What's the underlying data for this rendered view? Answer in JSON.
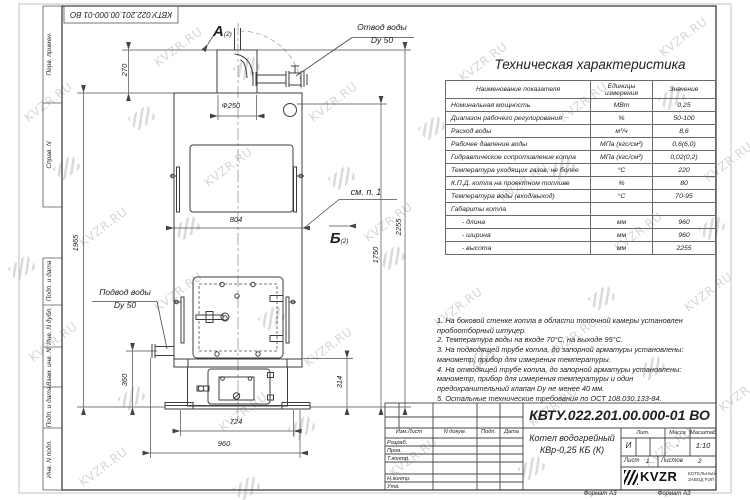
{
  "watermark": {
    "text": "KVZR.RU",
    "text_positions": [
      [
        20,
        95
      ],
      [
        75,
        220
      ],
      [
        25,
        335
      ],
      [
        75,
        460
      ],
      [
        150,
        40
      ],
      [
        200,
        160
      ],
      [
        150,
        285
      ],
      [
        215,
        405
      ],
      [
        305,
        95
      ],
      [
        360,
        215
      ],
      [
        300,
        340
      ],
      [
        385,
        450
      ],
      [
        455,
        55
      ],
      [
        495,
        175
      ],
      [
        430,
        300
      ],
      [
        525,
        400
      ],
      [
        555,
        95
      ],
      [
        610,
        225
      ],
      [
        545,
        330
      ],
      [
        640,
        440
      ],
      [
        655,
        30
      ],
      [
        700,
        155
      ],
      [
        680,
        285
      ],
      [
        715,
        385
      ]
    ],
    "logo_positions": [
      [
        55,
        160
      ],
      [
        10,
        260
      ],
      [
        130,
        110
      ],
      [
        235,
        60
      ],
      [
        175,
        220
      ],
      [
        120,
        390
      ],
      [
        260,
        310
      ],
      [
        330,
        170
      ],
      [
        290,
        420
      ],
      [
        420,
        120
      ],
      [
        380,
        250
      ],
      [
        470,
        350
      ],
      [
        550,
        160
      ],
      [
        590,
        290
      ],
      [
        520,
        460
      ],
      [
        660,
        90
      ],
      [
        700,
        220
      ],
      [
        640,
        360
      ],
      [
        235,
        480
      ]
    ]
  },
  "corner_stamp": {
    "doc_number": "КВТУ.022.201.00.000-01 ВО"
  },
  "side_strip": {
    "items": [
      {
        "label": "Перв. примен."
      },
      {
        "label": "Справ. N"
      },
      {
        "label": "Подп. и дата"
      },
      {
        "label": "Инв. N дубл."
      },
      {
        "label": "Взам. инв. N"
      },
      {
        "label": "Подп. и дата"
      },
      {
        "label": "Инв. N подл."
      }
    ]
  },
  "drawing": {
    "view_a": {
      "letter": "А",
      "ref": "(2)"
    },
    "view_b": {
      "letter": "Б",
      "ref": "(2)"
    },
    "outlet": {
      "line1": "Отвод воды",
      "line2": "Dy 50"
    },
    "inlet": {
      "line1": "Подвод воды",
      "line2": "Dy 50"
    },
    "see_note": "см. п. 1",
    "dims": {
      "top_offset": "270",
      "left_height": "1965",
      "chimney_dia": "Ф250",
      "panel_width": "804",
      "total_height": "2255",
      "right_mid": "1750",
      "inlet_height": "360",
      "base_height": "314",
      "base_width": "724",
      "overall_width": "960"
    }
  },
  "spec_table": {
    "title": "Техническая характеристика",
    "headers": [
      "Наименование показателя",
      "Единицы\nизмерения",
      "Значение"
    ],
    "rows": [
      [
        "Номинальная мощность",
        "МВт",
        "0,25"
      ],
      [
        "Диапазон рабочего регулирования",
        "%",
        "50-100"
      ],
      [
        "Расход воды",
        "м³/ч",
        "8,6"
      ],
      [
        "Рабочее давление воды",
        "МПа (кгс/см²)",
        "0,6(6,0)"
      ],
      [
        "Гидравлическое сопротивление котла",
        "МПа (кгс/см²)",
        "0,02(0,2)"
      ],
      [
        "Температура уходящих газов, не более",
        "°С",
        "220"
      ],
      [
        "К.П.Д. котла на проектном топливе",
        "%",
        "80"
      ],
      [
        "Температура воды (вход/выход)",
        "°С",
        "70-95"
      ],
      [
        "Габариты котла",
        "",
        ""
      ],
      [
        "- длина",
        "мм",
        "960"
      ],
      [
        "- ширина",
        "мм",
        "960"
      ],
      [
        "- высота",
        "мм",
        "2255"
      ]
    ]
  },
  "notes": {
    "items": [
      "1. На боковой стенке котла в области топочной камеры установлен пробоотборный штуцер.",
      "2. Температура воды на входе 70°С, на выходе 95°С.",
      "3. На подводящей трубе котла, до запорной арматуры установлены: манометр, прибор для измерения температуры.",
      "4. На отводящей трубе котла, до запорной арматуры установлены: манометр, прибор для измерения температуры и один предохранительный клапан Dу не менее 40 мм.",
      "5. Остальные технические требования по ОСТ 108.030.133-84."
    ]
  },
  "title_block": {
    "doc_number": "КВТУ.022.201.00.000-01 ВО",
    "product_name_1": "Котел водогрейный",
    "product_name_2": "КВр-0,25 КБ (К)",
    "col_izm_list": "Изм.Лист",
    "col_doc": "N докум.",
    "col_sign": "Подп.",
    "col_date": "Дата",
    "roles": [
      "Разраб.",
      "Пров.",
      "Т.контр.",
      "",
      "Н.контр.",
      "Утв."
    ],
    "lit_header": "Лит.",
    "mass_header": "Масса",
    "scale_header": "Масштаб",
    "lit_value": "И",
    "mass_value": "-",
    "scale_value": "1:10",
    "sheet_label": "Лист",
    "sheet_value": "1",
    "sheets_label": "Листов",
    "sheets_value": "2",
    "brand": "KVZR",
    "brand_sub1": "КОТЕЛЬНЫЙ",
    "brand_sub2": "ЗАВОД РЭП",
    "format_label": "Формат А3"
  }
}
